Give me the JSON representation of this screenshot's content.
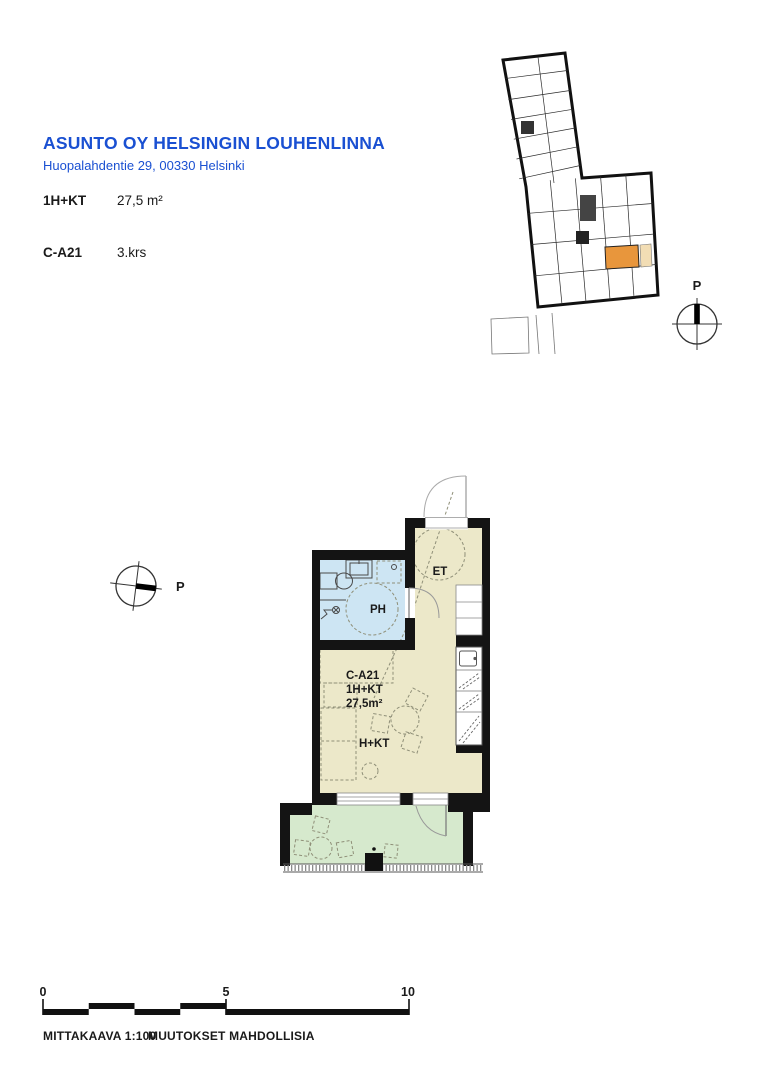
{
  "header": {
    "title": "ASUNTO OY HELSINGIN LOUHENLINNA",
    "address": "Huopalahdentie 29, 00330 Helsinki",
    "unit_type_label": "1H+KT",
    "unit_area": "27,5 m²",
    "unit_code": "C-A21",
    "unit_floor": "3.krs"
  },
  "site_plan": {
    "north_label": "P",
    "highlight_color": "#e8963c",
    "highlight_balcony_color": "#f2ddb4"
  },
  "floor_plan": {
    "north_label": "P",
    "entry_label": "ET",
    "bathroom_label": "PH",
    "room_label": "H+KT",
    "unit_code": "C-A21",
    "unit_type": "1H+KT",
    "unit_area": "27,5m²",
    "colors": {
      "room": "#ece8c9",
      "bathroom": "#cde5f3",
      "balcony": "#d6e9cd",
      "wall": "#141414"
    }
  },
  "scale_bar": {
    "ticks": [
      "0",
      "5",
      "10"
    ]
  },
  "footer": {
    "scale_label": "MITTAKAAVA 1:100",
    "note": "MUUTOKSET MAHDOLLISIA"
  },
  "accent_color": "#1a50d2"
}
